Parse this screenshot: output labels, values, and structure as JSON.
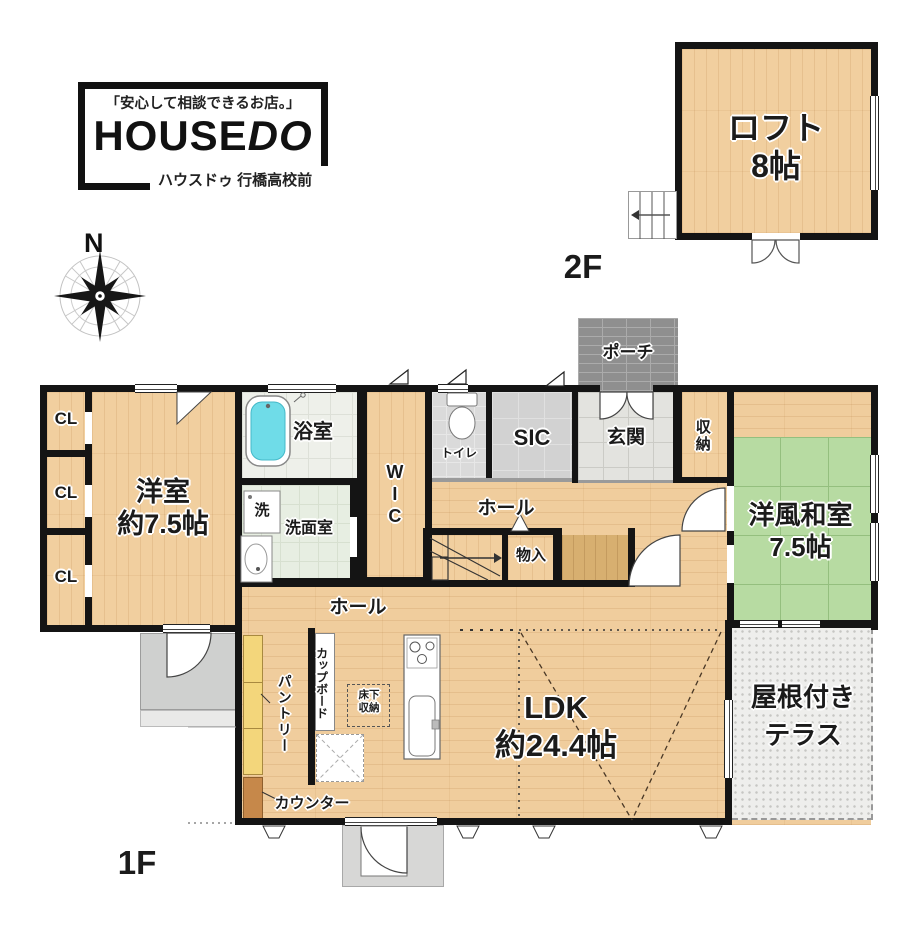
{
  "branding": {
    "tagline": "「安心して相談できるお店。」",
    "brand_main": "HOUSE",
    "brand_accent": "DO",
    "store_name": "ハウスドゥ 行橋高校前"
  },
  "compass": {
    "north": "N"
  },
  "floors": {
    "first_label": "1F",
    "second_label": "2F"
  },
  "loft": {
    "name": "ロフト",
    "size": "8帖"
  },
  "rooms": {
    "western": {
      "name": "洋室",
      "size": "約7.5帖"
    },
    "closets": [
      "CL",
      "CL",
      "CL"
    ],
    "bathroom": "浴室",
    "laundry": "洗",
    "washroom": "洗面室",
    "wic": "WIC",
    "toilet": "トイレ",
    "sic": "SIC",
    "entrance": "玄関",
    "porch": "ポーチ",
    "storage": "収納",
    "japanese": {
      "name": "洋風和室",
      "size": "7.5帖"
    },
    "hall_upper": "ホール",
    "hall_lower": "ホール",
    "small_storage": "物入",
    "ldk": {
      "name": "LDK",
      "size": "約24.4帖"
    },
    "pantry": "パントリー",
    "cupboard": "カップボード",
    "underfloor": {
      "line1": "床下",
      "line2": "収納"
    },
    "counter": "カウンター",
    "terrace": {
      "line1": "屋根付き",
      "line2": "テラス"
    }
  },
  "colors": {
    "wall": "#141414",
    "wood_floor": "#f0cd9d",
    "tatami_green": "#b7dba2",
    "bathtub_cyan": "#6fdce8",
    "pantry_shelf": "#f3d67b",
    "counter_shelf": "#c6884a",
    "porch_brick": "#8f8f8f",
    "terrace_floor": "#eeeeec",
    "gray_tile": "#d2d2d2"
  }
}
